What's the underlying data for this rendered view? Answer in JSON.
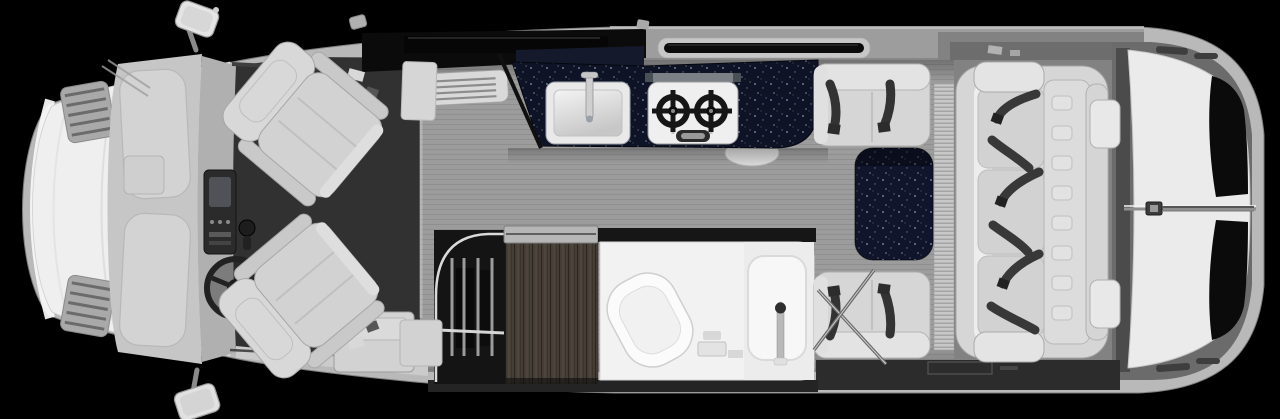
{
  "meta": {
    "title": "Motorhome floor plan — top-down cutaway view",
    "type": "rv-floor-plan",
    "canvas": {
      "width": 1280,
      "height": 419
    }
  },
  "colors": {
    "background": "#000000",
    "body_shell": "#b9b9b9",
    "hood": "#efefef",
    "windshield_glass": "#c6c6c6",
    "cab_floor": "#313131",
    "wall": "#9d9d9d",
    "window_glass": "#0b0b0b",
    "floor_plank": "#9c9c9c",
    "lounge_floor": "#828282",
    "countertop": "#0e1326",
    "dinette_table": "#10152b",
    "upholstery": "#d6d6d6",
    "seat_belt": "#383838",
    "wardrobe_wood": "#463f37",
    "closet_interior": "#141414",
    "bathroom_floor": "#f2f2f2",
    "rear_door_panel": "#ebebeb",
    "bottom_wall": "#2c2c2c",
    "appliance_white": "#efefef",
    "steel_trim": "#c9c9c9"
  },
  "areas": {
    "cab": {
      "name": "driver-cab",
      "components": [
        "hood",
        "hood-vents",
        "windshield",
        "dashboard",
        "steering-wheel",
        "driver-swivel-seat",
        "passenger-swivel-seat",
        "side-mirror-top",
        "side-mirror-bottom"
      ]
    },
    "galley": {
      "name": "galley-kitchen",
      "components": [
        "solid-surface-countertop",
        "single-basin-sink",
        "faucet",
        "two-burner-cooktop",
        "galley-window",
        "roof-vent-unit"
      ]
    },
    "dinette": {
      "name": "belted-dinette",
      "components": [
        "forward-belted-seat",
        "rear-belted-seat",
        "pedestal-table",
        "folding-table-legs",
        "shoulder-belts"
      ]
    },
    "wet_bath": {
      "name": "wet-bath",
      "components": [
        "toilet",
        "shower-pan",
        "shower-wand",
        "sliding-wood-door",
        "hanging-wardrobe",
        "wardrobe-rod"
      ]
    },
    "rear_lounge": {
      "name": "rear-lounge",
      "components": [
        "three-seat-sofa",
        "shoulder-seat-belts",
        "rear-door-window-upper",
        "rear-door-window-lower",
        "rear-door-handle",
        "heater-register"
      ]
    },
    "entry": {
      "name": "entry-area",
      "components": [
        "entry-step",
        "entry-sill"
      ]
    }
  }
}
